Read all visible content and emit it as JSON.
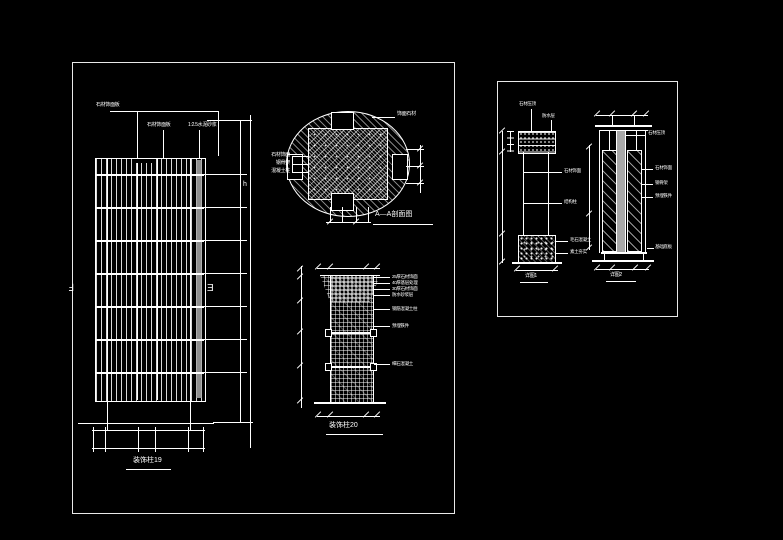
{
  "colors": {
    "background": "#000000",
    "line": "#ffffff",
    "gray_fill": "#a8a8a8"
  },
  "frame1": {
    "elevation": {
      "top_labels": [
        "石材饰面板",
        "石材饰面板",
        "1:2.5水泥砂浆"
      ],
      "section_marker_left": "Ⅎ",
      "section_marker_right": "Ǝ",
      "height_label": "h",
      "caption": "装饰柱19"
    },
    "plan": {
      "left_labels": [
        "石材饰面",
        "钢骨架",
        "混凝土柱"
      ],
      "top_right_label": "饰面石材",
      "caption": "A—A剖面图"
    },
    "detail20": {
      "right_labels": [
        "25厚石材饰面",
        "40厚基层处理",
        "30厚石材饰面",
        "防水砂浆层",
        "钢筋混凝土柱",
        "预埋铁件",
        "细石混凝土"
      ],
      "caption": "装饰柱20"
    }
  },
  "frame2": {
    "left_detail": {
      "top_labels": [
        "石材压顶",
        "防水层"
      ],
      "shaft_labels": [
        "石材饰面",
        "结构柱"
      ],
      "base_labels": [
        "毛石混凝土",
        "素土夯实"
      ],
      "caption": "详图1"
    },
    "right_detail": {
      "top_label": "石材压顶",
      "right_labels": [
        "石材饰面",
        "钢骨架",
        "预埋铁件",
        "基础底板"
      ],
      "caption": "详图2"
    }
  }
}
